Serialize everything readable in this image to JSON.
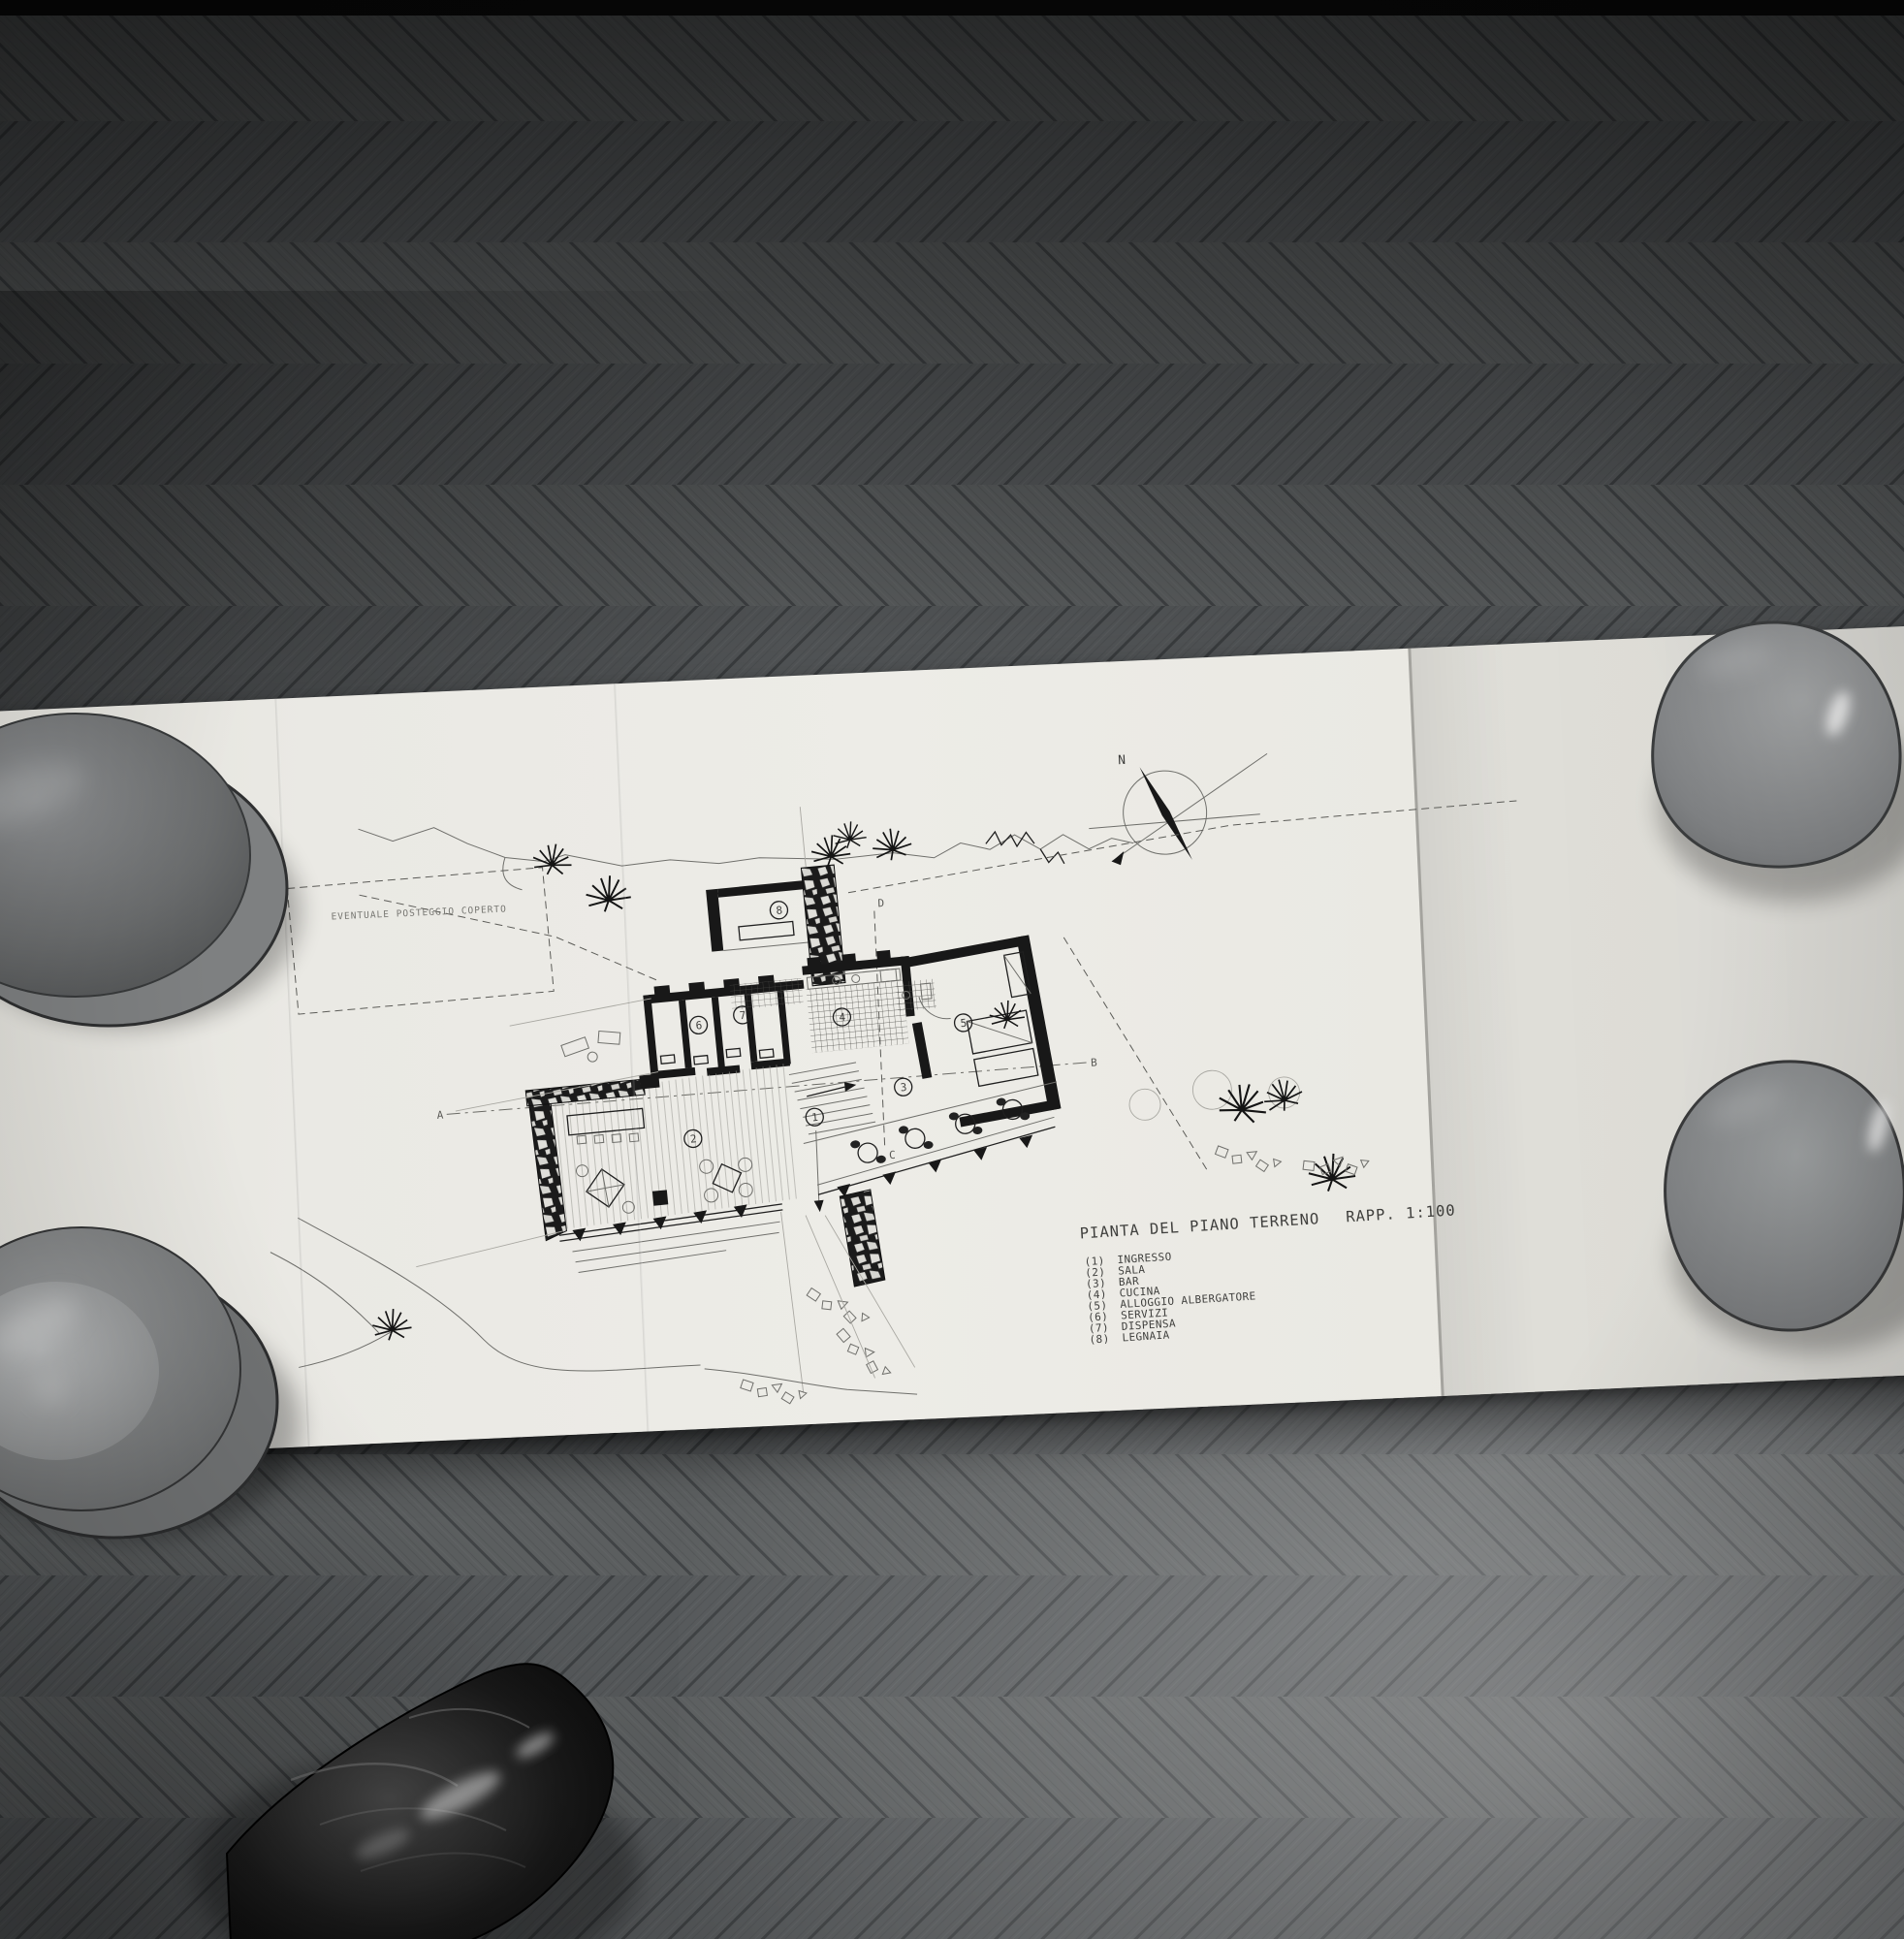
{
  "drawing": {
    "title": "PIANTA DEL PIANO TERRENO",
    "scale_label": "RAPP. 1:100",
    "site_label": "EVENTUALE POSTEGGIO COPERTO",
    "compass_north_label": "N",
    "section_labels": {
      "a": "A",
      "b": "B",
      "c": "C",
      "d": "D"
    },
    "room_numbers": [
      "1",
      "2",
      "3",
      "4",
      "5",
      "6",
      "7",
      "8"
    ],
    "legend": {
      "items": [
        {
          "num": "(1)",
          "label": "INGRESSO"
        },
        {
          "num": "(2)",
          "label": "SALA"
        },
        {
          "num": "(3)",
          "label": "BAR"
        },
        {
          "num": "(4)",
          "label": "CUCINA"
        },
        {
          "num": "(5)",
          "label": "ALLOGGIO ALBERGATORE"
        },
        {
          "num": "(6)",
          "label": "SERVIZI"
        },
        {
          "num": "(7)",
          "label": "DISPENSA"
        },
        {
          "num": "(8)",
          "label": "LEGNAIA"
        }
      ]
    }
  },
  "colors": {
    "paper": "#eae9e4",
    "ink": "#1f1f1f",
    "floor_dark": "#3f4244",
    "floor_mid": "#5b5e5f",
    "floor_light": "#8d9091",
    "bowl_gray": "#85878a",
    "shoe_black": "#0b0b0b"
  }
}
